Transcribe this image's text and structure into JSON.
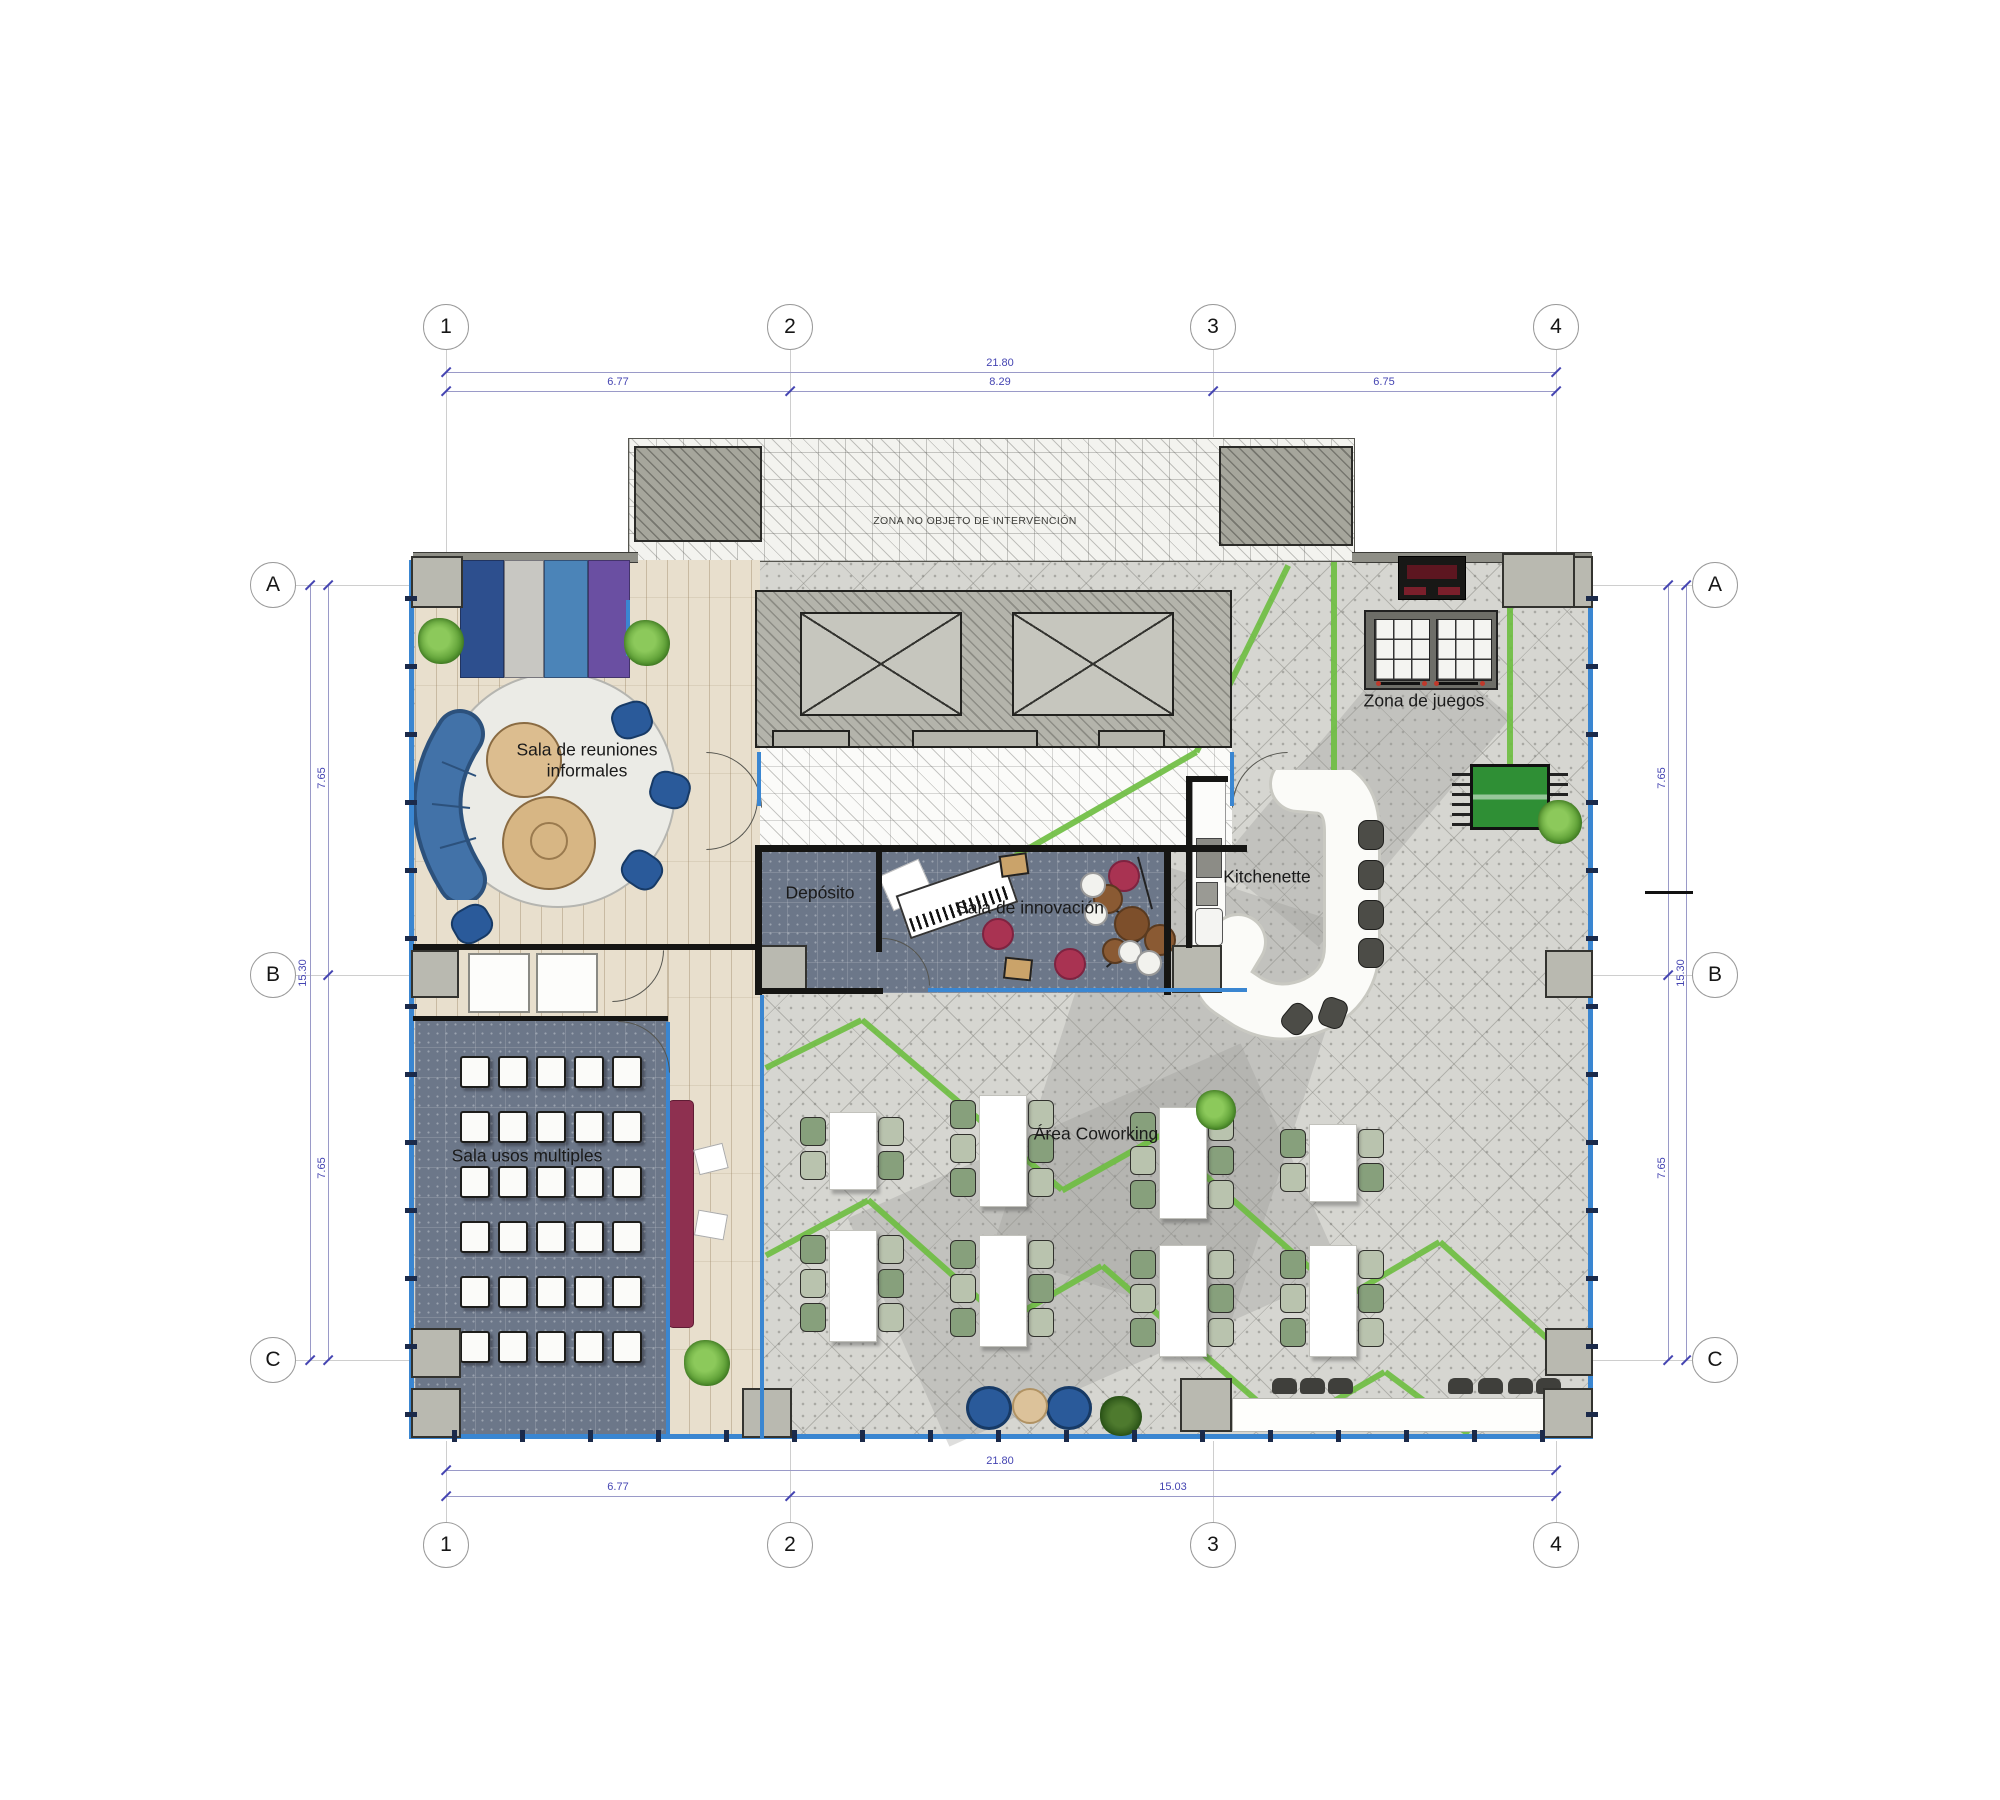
{
  "grid": {
    "cols": [
      "1",
      "2",
      "3",
      "4"
    ],
    "rows": [
      "A",
      "B",
      "C"
    ]
  },
  "dimensions": {
    "top_overall": "21.80",
    "top_seg1": "6.77",
    "top_seg2": "8.29",
    "top_seg3": "6.75",
    "bottom_overall": "21.80",
    "bottom_seg1": "6.77",
    "bottom_seg2": "15.03",
    "left_top": "7.65",
    "left_overall": "15.30",
    "left_bottom": "7.65",
    "right_top": "7.65",
    "right_overall": "15.30",
    "right_bottom": "7.65",
    "kitchenette_width": "1.50"
  },
  "rooms": {
    "informal_meeting": {
      "line1": "Sala de reuniones",
      "line2": "informales"
    },
    "storage": {
      "label": "Depósito"
    },
    "innovation": {
      "label": "Sala de innovación"
    },
    "kitchenette": {
      "label": "Kitchenette"
    },
    "games": {
      "label": "Zona de juegos"
    },
    "multipurpose": {
      "label": "Sala usos multiples"
    },
    "coworking": {
      "label": "Área Coworking"
    },
    "no_intervention": {
      "label": "ZONA NO OBJETO DE INTERVENCIÓN"
    }
  },
  "colors": {
    "dimension": "#4545b2",
    "glazing": "#3a86d1",
    "green_path": "#6fbe42",
    "slate_floor": "#6c7789",
    "wood_floor": "#e8dfcd",
    "concrete_floor": "#d6d6d1",
    "maroon": "#8e3050",
    "crimson": "#a93352",
    "navy": "#2d4f8e",
    "steel_blue": "#4b84b8",
    "purple": "#6a4fa2",
    "sofa_blue": "#3a679f",
    "foosball_green": "#2f8f35",
    "chair_green": "#87a07c"
  },
  "gen": {
    "green_segments": [
      [
        1288,
        565,
        1196,
        752
      ],
      [
        1196,
        752,
        1008,
        860
      ],
      [
        1334,
        562,
        1334,
        830
      ],
      [
        1510,
        562,
        1510,
        830
      ],
      [
        766,
        1068,
        862,
        1020
      ],
      [
        862,
        1020,
        1062,
        1190
      ],
      [
        1062,
        1190,
        1160,
        1135
      ],
      [
        1160,
        1135,
        1345,
        1298
      ],
      [
        1345,
        1298,
        1440,
        1242
      ],
      [
        1440,
        1242,
        1562,
        1352
      ],
      [
        766,
        1255,
        868,
        1200
      ],
      [
        868,
        1200,
        1005,
        1322
      ],
      [
        1005,
        1322,
        1102,
        1266
      ],
      [
        1102,
        1266,
        1288,
        1428
      ],
      [
        1288,
        1428,
        1385,
        1372
      ],
      [
        1385,
        1372,
        1468,
        1434
      ]
    ],
    "multipurpose_chairs": {
      "x0": 460,
      "y0": 1056,
      "dx": 38,
      "dy": 55,
      "rows": 6,
      "cols": 5
    },
    "coworking_tables": [
      {
        "x": 852,
        "y": 1150,
        "seats": 2
      },
      {
        "x": 852,
        "y": 1285,
        "seats": 3
      },
      {
        "x": 1002,
        "y": 1150,
        "seats": 3
      },
      {
        "x": 1002,
        "y": 1290,
        "seats": 3
      },
      {
        "x": 1182,
        "y": 1162,
        "seats": 3
      },
      {
        "x": 1182,
        "y": 1300,
        "seats": 3
      },
      {
        "x": 1332,
        "y": 1162,
        "seats": 2
      },
      {
        "x": 1332,
        "y": 1300,
        "seats": 3
      }
    ],
    "bar_stools": [
      [
        1358,
        820,
        0
      ],
      [
        1358,
        860,
        0
      ],
      [
        1358,
        900,
        0
      ],
      [
        1358,
        938,
        0
      ],
      [
        1284,
        1004,
        40
      ],
      [
        1320,
        998,
        20
      ]
    ],
    "counter_stools": [
      [
        1272,
        1378
      ],
      [
        1300,
        1378
      ],
      [
        1328,
        1378
      ],
      [
        1448,
        1378
      ],
      [
        1478,
        1378
      ],
      [
        1508,
        1378
      ],
      [
        1536,
        1378
      ]
    ],
    "slashes": [
      [
        446,
        372
      ],
      [
        1556,
        372
      ],
      [
        446,
        391
      ],
      [
        790,
        391
      ],
      [
        1213,
        391
      ],
      [
        1556,
        391
      ],
      [
        446,
        1470
      ],
      [
        1556,
        1470
      ],
      [
        446,
        1496
      ],
      [
        790,
        1496
      ],
      [
        1556,
        1496
      ],
      [
        310,
        585
      ],
      [
        310,
        1360
      ],
      [
        328,
        585
      ],
      [
        328,
        975
      ],
      [
        328,
        1360
      ],
      [
        1668,
        585
      ],
      [
        1668,
        975
      ],
      [
        1668,
        1360
      ],
      [
        1686,
        585
      ],
      [
        1686,
        1360
      ],
      [
        1227,
        788
      ],
      [
        1298,
        788
      ]
    ],
    "glazing_ticks": {
      "left": {
        "x": 405,
        "y1": 596,
        "y2": 1420,
        "step": 68
      },
      "bottom": {
        "y": 1430,
        "x1": 452,
        "x2": 1575,
        "step": 68
      },
      "right": {
        "x": 1586,
        "y1": 596,
        "y2": 1420,
        "step": 68
      }
    }
  }
}
